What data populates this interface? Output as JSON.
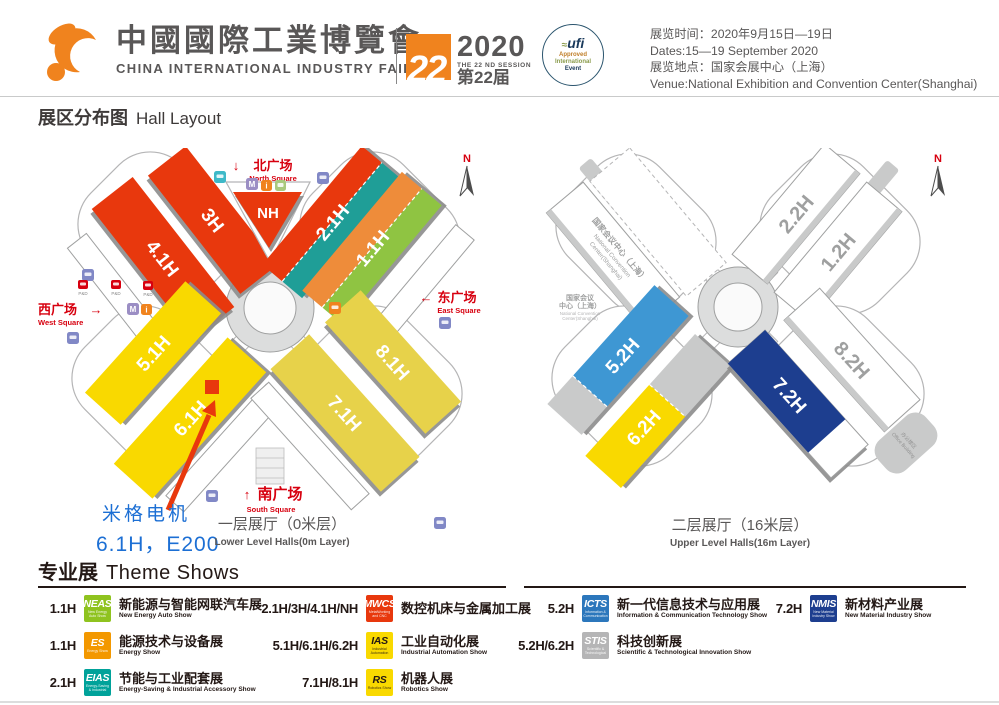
{
  "header": {
    "logo_color": "#F0831E",
    "title_zh": "中國國際工業博覽會",
    "title_en": "CHINA INTERNATIONAL INDUSTRY FAIR",
    "badge": {
      "number": "22",
      "year": "2020",
      "session_en": "THE 22 ND SESSION",
      "session_zh": "第22届",
      "color": "#F0831E"
    },
    "ufi": {
      "name": "ufi",
      "line1": "Approved",
      "line2": "International",
      "line3": "Event"
    },
    "info": {
      "time_zh": "展览时间：2020年9月15日—19日",
      "time_en": "Dates:15—19 September 2020",
      "venue_zh": "展览地点：国家会展中心（上海）",
      "venue_en": "Venue:National Exhibition and Convention Center(Shanghai)"
    }
  },
  "section_title": {
    "zh": "展区分布图",
    "en": "Hall Layout"
  },
  "lower_map": {
    "compass": "N",
    "squares": {
      "north_zh": "北广场",
      "north_en": "North Square",
      "north_arrow": "↓",
      "south_zh": "南广场",
      "south_en": "South Square",
      "south_arrow": "↑",
      "east_zh": "东广场",
      "east_en": "East Square",
      "east_arrow": "←",
      "west_zh": "西广场",
      "west_en": "West Square",
      "west_arrow": "→"
    },
    "pd_label": "P&D",
    "halls": [
      {
        "id": "4.1H",
        "color": "#E8380D"
      },
      {
        "id": "3H",
        "color": "#E8380D"
      },
      {
        "id": "NH",
        "color": "#E8380D"
      },
      {
        "id": "2.1H",
        "color": "#E8380D",
        "color2": "#1F9E97"
      },
      {
        "id": "1.1H",
        "color": "#EE8C3A",
        "color2": "#8FC442"
      },
      {
        "id": "5.1H",
        "color": "#F9D900"
      },
      {
        "id": "6.1H",
        "color": "#F9D900"
      },
      {
        "id": "7.1H",
        "color": "#E7D24A"
      },
      {
        "id": "8.1H",
        "color": "#E7D24A"
      }
    ],
    "annotation": {
      "company": "米格电机",
      "booth": "6.1H，E200",
      "color": "#1C6FD4",
      "marker_color": "#E8380D"
    },
    "caption_zh": "一层展厅（0米层）",
    "caption_en": "Lower Level Halls(0m Layer)"
  },
  "upper_map": {
    "compass": "N",
    "convention_line1": "国家会议中心（上海）",
    "convention_line2": "National Convention",
    "convention_line3": "Center(Shanghai)",
    "side_line1": "国家会议",
    "side_line2": "中心（上海）",
    "side_line3": "National Convention",
    "side_line4": "Center(Shanghai)",
    "office_zh": "办公楼区",
    "office_en": "Office Building",
    "halls": [
      {
        "id": "2.2H",
        "color": "#FFFFFF",
        "text_color": "#9FA0A0"
      },
      {
        "id": "1.2H",
        "color": "#FFFFFF",
        "text_color": "#9FA0A0"
      },
      {
        "id": "5.2H",
        "color": "#3E97D3",
        "end_color": "#C9CACA"
      },
      {
        "id": "6.2H",
        "color": "#F9D900",
        "end_color": "#C9CACA"
      },
      {
        "id": "7.2H",
        "color": "#1D3E8F"
      },
      {
        "id": "8.2H",
        "color": "#FFFFFF",
        "text_color": "#9FA0A0"
      }
    ],
    "caption_zh": "二层展厅（16米层）",
    "caption_en": "Upper Level Halls(16m Layer)"
  },
  "theme_shows": {
    "title_zh": "专业展",
    "title_en": "Theme Shows",
    "items": [
      {
        "halls": "1.1H",
        "logo": "NEAS",
        "logo_color": "#8FC31F",
        "zh": "新能源与智能网联汽车展",
        "en": "New Energy Auto Show"
      },
      {
        "halls": "1.1H",
        "logo": "ES",
        "logo_color": "#F39800",
        "zh": "能源技术与设备展",
        "en": "Energy Show"
      },
      {
        "halls": "2.1H",
        "logo": "EIAS",
        "logo_color": "#00A29A",
        "zh": "节能与工业配套展",
        "en": "Energy-Saving & Industrial Accessory Show"
      },
      {
        "halls": "2.1H/3H/4.1H/NH",
        "logo": "MWCS",
        "logo_color": "#E8380D",
        "zh": "数控机床与金属加工展",
        "en": "MetalWorking and CNC Machine Tool Show"
      },
      {
        "halls": "5.1H/6.1H/6.2H",
        "logo": "IAS",
        "logo_color": "#F9D900",
        "zh": "工业自动化展",
        "en": "Industrial Automation Show"
      },
      {
        "halls": "7.1H/8.1H",
        "logo": "RS",
        "logo_color": "#F9D900",
        "zh": "机器人展",
        "en": "Robotics Show"
      },
      {
        "halls": "5.2H",
        "logo": "ICTS",
        "logo_color": "#2C77BC",
        "zh": "新一代信息技术与应用展",
        "en": "Information & Communication Technology Show"
      },
      {
        "halls": "5.2H/6.2H",
        "logo": "STIS",
        "logo_color": "#B5B5B6",
        "zh": "科技创新展",
        "en": "Scientific & Technological Innovation Show"
      },
      {
        "halls": "7.2H",
        "logo": "NMIS",
        "logo_color": "#1D3E8F",
        "zh": "新材料产业展",
        "en": "New Material Industry Show"
      }
    ]
  }
}
